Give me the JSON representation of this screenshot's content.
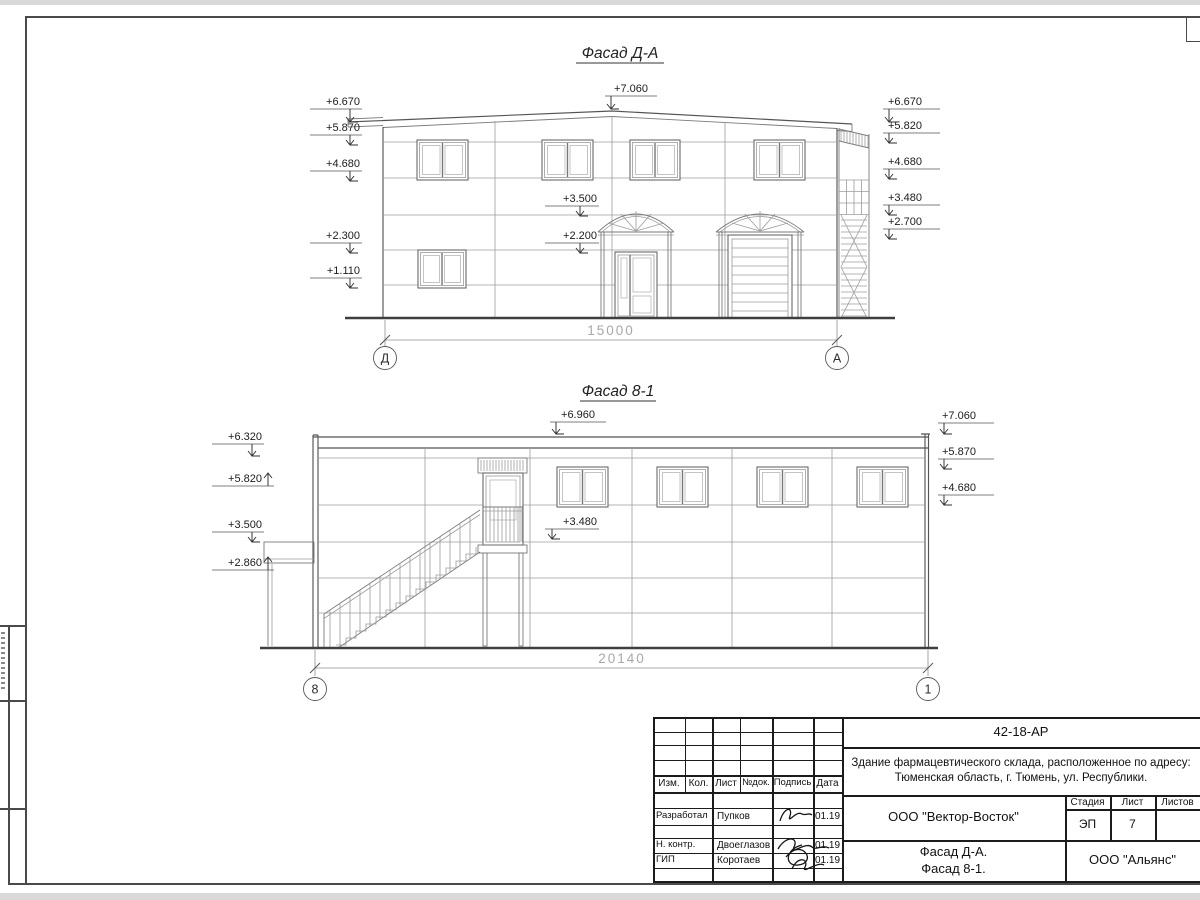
{
  "colors": {
    "paper": "#ffffff",
    "line": "#4d4d4d",
    "dim_text": "#a8a8a8"
  },
  "facade_da": {
    "title": "Фасад Д-А",
    "marks_left": [
      "+6.670",
      "+5.870",
      "+4.680",
      "+2.300",
      "+1.110"
    ],
    "mark_top": "+7.060",
    "marks_mid": [
      "+3.500",
      "+2.200"
    ],
    "marks_right": [
      "+6.670",
      "+5.820",
      "+4.680",
      "+3.480",
      "+2.700"
    ],
    "dimension": "15000",
    "axis_left": "Д",
    "axis_right": "А"
  },
  "facade_81": {
    "title": "Фасад 8-1",
    "marks_left": [
      "+6.320",
      "+5.820",
      "+3.500",
      "+2.860"
    ],
    "mark_top": "+6.960",
    "marks_mid": [
      "+3.480"
    ],
    "marks_right": [
      "+7.060",
      "+5.870",
      "+4.680"
    ],
    "dimension": "20140",
    "axis_left": "8",
    "axis_right": "1"
  },
  "title_block": {
    "code": "42-18-АР",
    "object_line1": "Здание фармацевтического склада, расположенное по адресу:",
    "object_line2": "Тюменская область, г. Тюмень, ул. Республики.",
    "cols": {
      "izm": "Изм.",
      "kol": "Кол.",
      "list": "Лист",
      "doc": "№док.",
      "sign": "Подпись",
      "date": "Дата"
    },
    "rows": [
      {
        "role": "Разработал",
        "name": "Пупков",
        "date": "01.19"
      },
      {
        "role": "Н. контр.",
        "name": "Двоеглазов",
        "date": "01.19"
      },
      {
        "role": "ГИП",
        "name": "Коротаев",
        "date": "01.19"
      }
    ],
    "designer": "ООО \"Вектор-Восток\"",
    "stage_label": "Стадия",
    "stage": "ЭП",
    "sheet_label": "Лист",
    "sheet": "7",
    "sheets_label": "Листов",
    "sheets": "",
    "drawing_title_line1": "Фасад Д-А.",
    "drawing_title_line2": "Фасад 8-1.",
    "client": "ООО \"Альянс\""
  }
}
